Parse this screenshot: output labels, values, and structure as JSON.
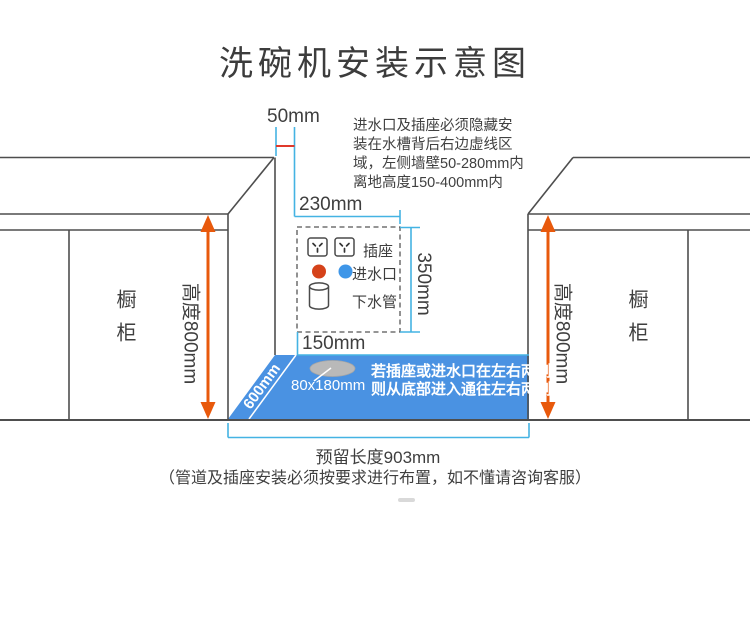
{
  "title": "洗碗机安装示意图",
  "note": {
    "line1": "进水口及插座必须隐藏安",
    "line2": "装在水槽背后右边虚线区",
    "line3": "域，左侧墙壁50-280mm内",
    "line4": "离地高度150-400mm内"
  },
  "dims": {
    "gap": "50mm",
    "zone_width": "230mm",
    "zone_height": "350mm",
    "zone_offset": "150mm",
    "floor_depth": "600mm",
    "hole_size": "80x180mm",
    "reserved_length": "预留长度903mm",
    "cabinet_height": "高度800mm"
  },
  "legend": {
    "socket": "插座",
    "water_inlet": "进水口",
    "drain_pipe": "下水管"
  },
  "floor_note": {
    "line1": "若插座或进水口在左右两侧",
    "line2": "则从底部进入通往左右两侧"
  },
  "cabinet_label": "橱柜",
  "footer": "（管道及插座安装必须按要求进行布置，如不懂请咨询客服）",
  "colors": {
    "floor_blue": "#4a92e2",
    "dimension_blue": "#44b3e3",
    "arrow_orange": "#e8590c",
    "gap_red_line": "#e0392b",
    "inlet_hot_red": "#d5421a",
    "inlet_cold_blue": "#3e96e8",
    "outline_gray": "#4e4e4e"
  }
}
